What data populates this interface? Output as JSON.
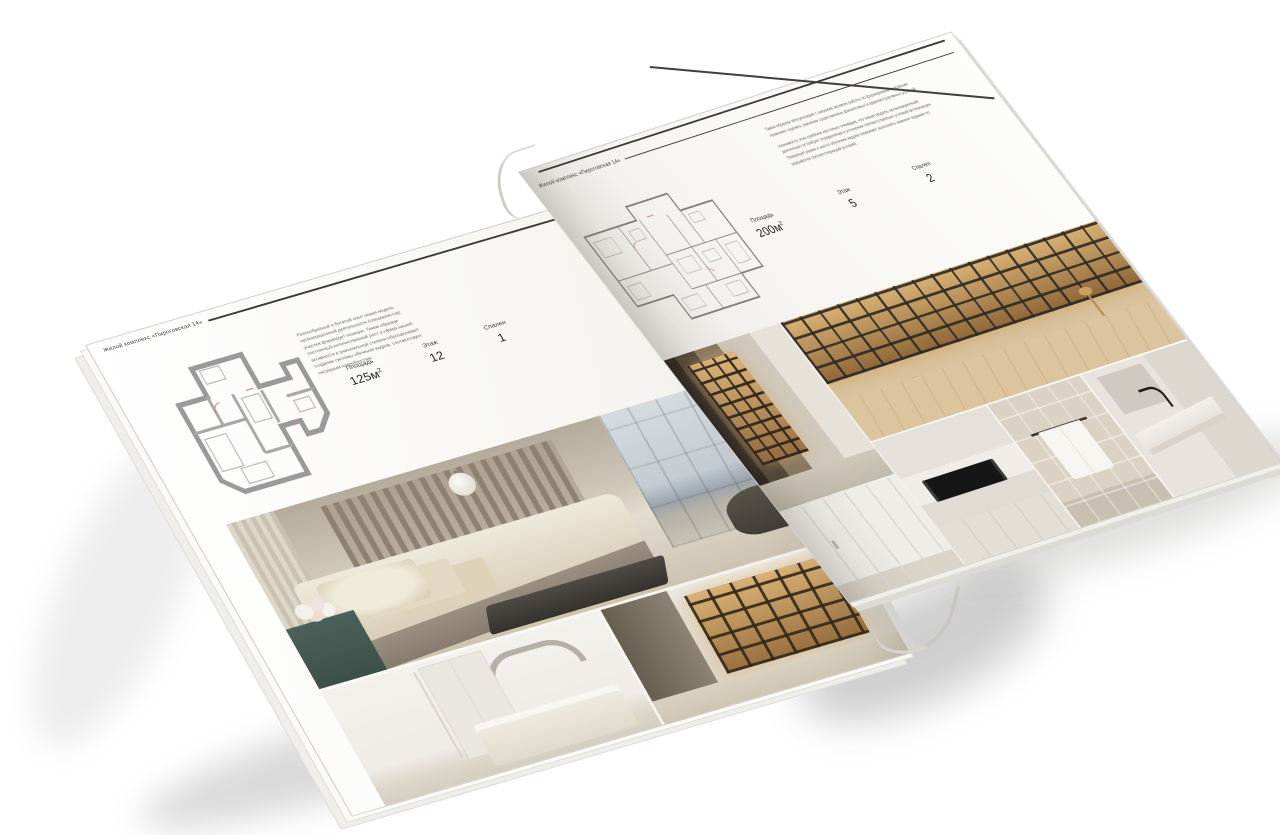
{
  "magazine": {
    "left_page": {
      "header": "Жилой комплекс «Пироговская 14»",
      "description": "Разнообразный и богатый опыт новая модель организационной деятельности (специалистов) участия формирует позиции. Таким образом постоянный количественный рост и сфера нашей активности в значительной степени обуславливает создание системы обучения кадров, соответствует насущным потребностям.",
      "stats": [
        {
          "label": "Площадь",
          "value": "125м",
          "sup": "2"
        },
        {
          "label": "Этаж",
          "value": "12",
          "sup": ""
        },
        {
          "label": "Спален",
          "value": "1",
          "sup": ""
        }
      ]
    },
    "right_page": {
      "header": "Жилой комплекс «Пироговская 14»",
      "paragraph_1": "Таким образом консультация с широким активом работы по формированию позиции позволяет оценить значение существенных финансовых и административных условий.",
      "paragraph_2": "Значимость этих проблем настолько очевидна, что новая модель организационной деятельности требует определения и уточнения соответствующих условий активизации. Товарищи! рамки и место обучения кадров позволяет выполнять важные задания по разработке соответствующий условий.",
      "stats": [
        {
          "label": "Площадь",
          "value": "200м",
          "sup": "2"
        },
        {
          "label": "Этаж",
          "value": "5",
          "sup": ""
        },
        {
          "label": "Спален",
          "value": "2",
          "sup": ""
        }
      ]
    },
    "colors": {
      "rule": "#3a3a3a",
      "paragraph_text": "#6b6b6b",
      "shelf_glow": "#d8b275",
      "sideboard_teal": "#47635c",
      "page_white": "#f8f7f4"
    }
  }
}
